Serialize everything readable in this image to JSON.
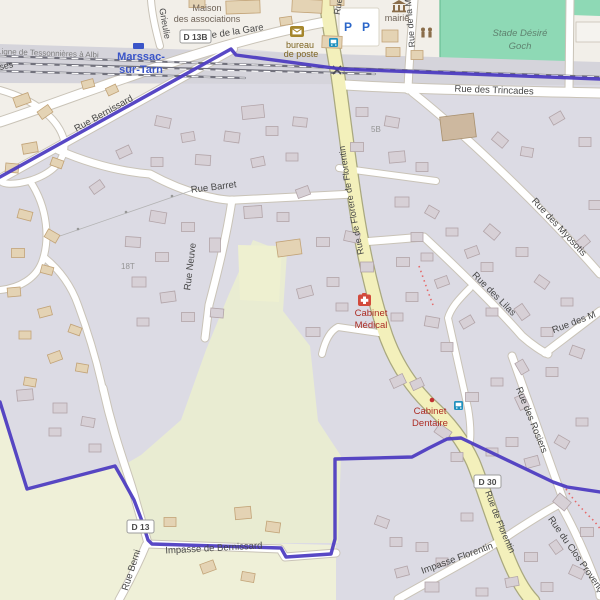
{
  "map": {
    "kind": "openstreetmap-view",
    "place": {
      "station_name_line1": "Marssac-",
      "station_name_line2": "sur-Tarn",
      "railway_line_name": "Ligne de Tessonnières à Albi"
    },
    "streets": {
      "grieulie": "Grieulie",
      "rue_de_la_gare": "Rue de la Gare",
      "rue_top": "Rue",
      "rue_de_la_m": "Rue de la M",
      "rue_des_trincades": "Rue des Trincades",
      "rue_bernissard": "Rue Bernissard",
      "rue_barret": "Rue Barret",
      "rue_neuve": "Rue Neuve",
      "rue_florere": "Rue de Florere de Florentin",
      "rue_des_myosotis": "Rue des Myosotis",
      "rue_des_lilas": "Rue des Lilas",
      "rue_des_m": "Rue des M",
      "rue_des_rosiers": "Rue des Rosiers",
      "rue_de_florentin": "Rue de Florentin",
      "impasse_florentin": "Impasse Florentin",
      "rue_du_clos": "Rue du Clos Provença",
      "impasse_de_bernissard": "Impasse de Bernissard",
      "rue_berni_south": "Rue Berni",
      "ses_partial": "ses"
    },
    "shields": {
      "d13b": "D 13B",
      "d30": "D 30",
      "d13": "D 13"
    },
    "pois": {
      "maison_line1": "Maison",
      "maison_line2": "des associations",
      "bureau_line1": "bureau",
      "bureau_line2": "de poste",
      "mairie": "mairie",
      "stade_line1": "Stade Désiré",
      "stade_line2": "Goch",
      "cabinet_medical_line1": "Cabinet",
      "cabinet_medical_line2": "Médical",
      "cabinet_dentaire_line1": "Cabinet",
      "cabinet_dentaire_line2": "Dentaire",
      "parking_letter": "P"
    },
    "housenumbers": {
      "n18t": "18T",
      "n5b": "5B"
    },
    "colors": {
      "boundary": "#4a38c0",
      "major_road": "#f3f0bb",
      "residential": "#dcdbe4",
      "farmland": "#e9ecd2",
      "pitch_green": "#8ed9b5",
      "railway_band": "#d5d4db",
      "poi_red": "#ac2d25",
      "amenity_brown": "#7d6420",
      "station_blue": "#3b55c8",
      "parking_blue": "#2b66c9"
    }
  }
}
